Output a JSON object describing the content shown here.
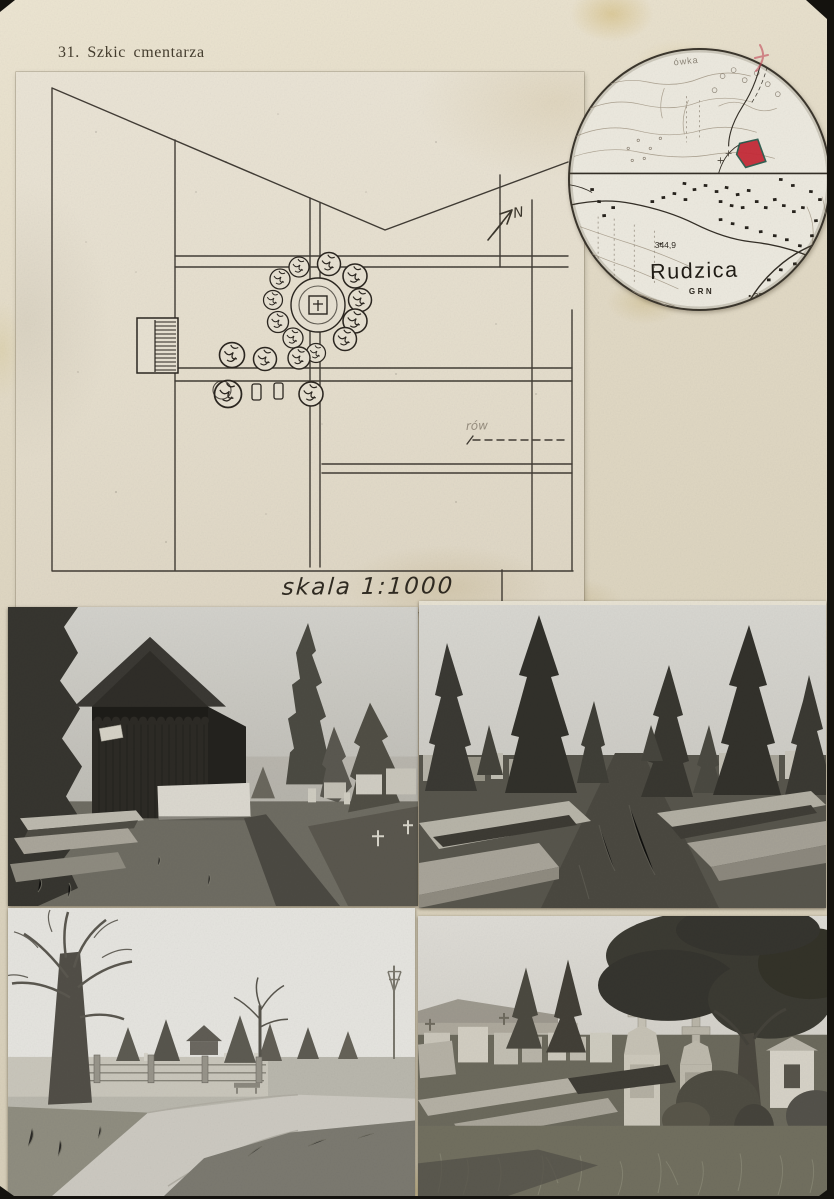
{
  "page": {
    "title": "31. Szkic cmentarza"
  },
  "sketch": {
    "scale_label": "skala 1:1000",
    "north_label": "N",
    "ditch_label": "rów"
  },
  "map_inset": {
    "place_name": "Rudzica",
    "admin_label": "GRN",
    "elevation_point_1": "344,9",
    "elevation_point_2": "323,4",
    "edge_label": "ówka",
    "marker_color": "#c62b38"
  },
  "photos": [
    {
      "name": "photo-1",
      "subject": "wooden cemetery chapel with graves and conifers"
    },
    {
      "name": "photo-2",
      "subject": "grassy cemetery alley lined with conifers and grave plots"
    },
    {
      "name": "photo-3",
      "subject": "road along cemetery fence with bare trees"
    },
    {
      "name": "photo-4",
      "subject": "old gravestones with crosses beneath a large tree"
    }
  ],
  "colors": {
    "backdrop": "#14120e",
    "card": "#ddd5c0",
    "sheet": "#e7e1d2",
    "map_paper": "#ece9df",
    "ink": "#2b2620",
    "marker_red": "#c62b38",
    "marker_outline": "#2a5a4c"
  }
}
